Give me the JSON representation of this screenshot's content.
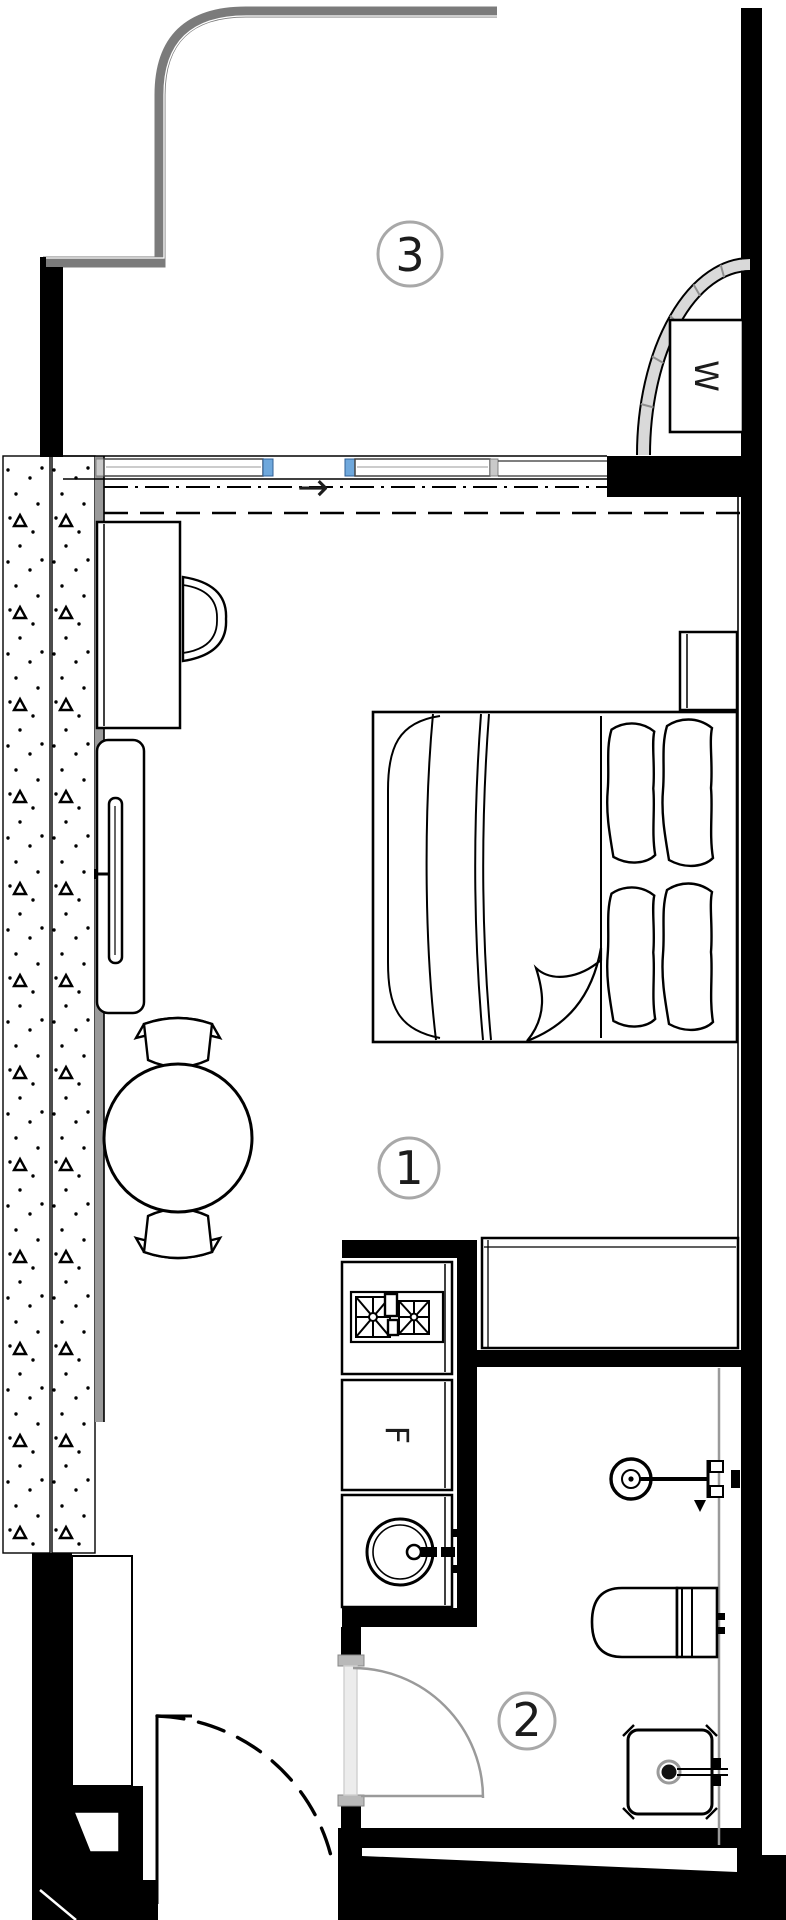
{
  "rooms": {
    "main": "1",
    "bathroom": "2",
    "balcony": "3"
  },
  "fixtures": {
    "wardrobe": "W",
    "fridge": "F"
  },
  "symbols": {
    "entry_arrow": "→"
  },
  "colors": {
    "wall": "#000000",
    "balcony_wall": "#7b7b7b",
    "window_accent": "#6fa8dc",
    "door_swing": "#9a9a9a",
    "door_leaf": "#ececec",
    "label_ring": "#a8a8a8",
    "hatch_strip": "#9a9a9a",
    "line": "#111111"
  }
}
